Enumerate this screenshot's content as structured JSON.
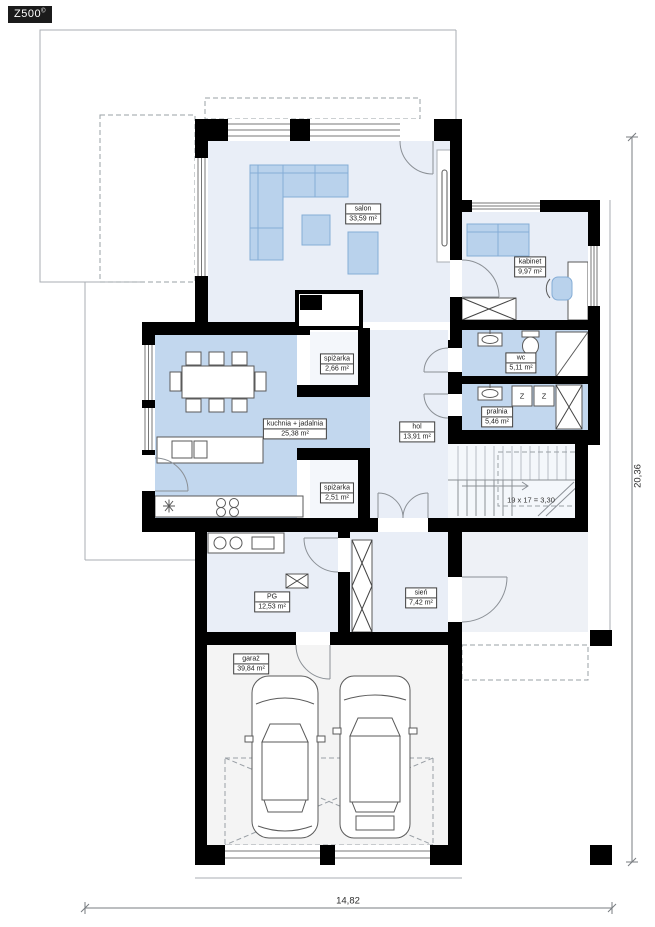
{
  "logo": {
    "text": "Z500",
    "mark": "©"
  },
  "plan": {
    "rooms": [
      {
        "id": "salon",
        "name": "salon",
        "area": "33,59 m²"
      },
      {
        "id": "kabinet",
        "name": "kabinet",
        "area": "9,97 m²"
      },
      {
        "id": "wc",
        "name": "wc",
        "area": "5,11 m²"
      },
      {
        "id": "pralnia",
        "name": "pralnia",
        "area": "5,46 m²"
      },
      {
        "id": "kuchnia",
        "name": "kuchnia + jadalnia",
        "area": "25,38 m²"
      },
      {
        "id": "hol",
        "name": "hol",
        "area": "13,91 m²"
      },
      {
        "id": "spizarka-1",
        "name": "spiżarka",
        "area": "2,66 m²"
      },
      {
        "id": "spizarka-2",
        "name": "spiżarka",
        "area": "2,51 m²"
      },
      {
        "id": "pg",
        "name": "PG",
        "area": "12,53 m²"
      },
      {
        "id": "sien",
        "name": "sień",
        "area": "7,42 m²"
      },
      {
        "id": "garaz",
        "name": "garaż",
        "area": "39,84 m²"
      }
    ],
    "stairs_note": "19 x 17 = 3,30",
    "appliance_labels": {
      "z": "Z"
    },
    "dimensions": {
      "width_m": "14,82",
      "height_m": "20,36"
    }
  },
  "colors": {
    "wall": "#000000",
    "roomLight": "#e9eef7",
    "roomBlue": "#c2d7ee",
    "roomPale": "#f4f7fb",
    "garage": "#f4f4f4",
    "porch": "#eef1f6",
    "furniture": "#b9d2ec",
    "furnitureStroke": "#85add6"
  }
}
